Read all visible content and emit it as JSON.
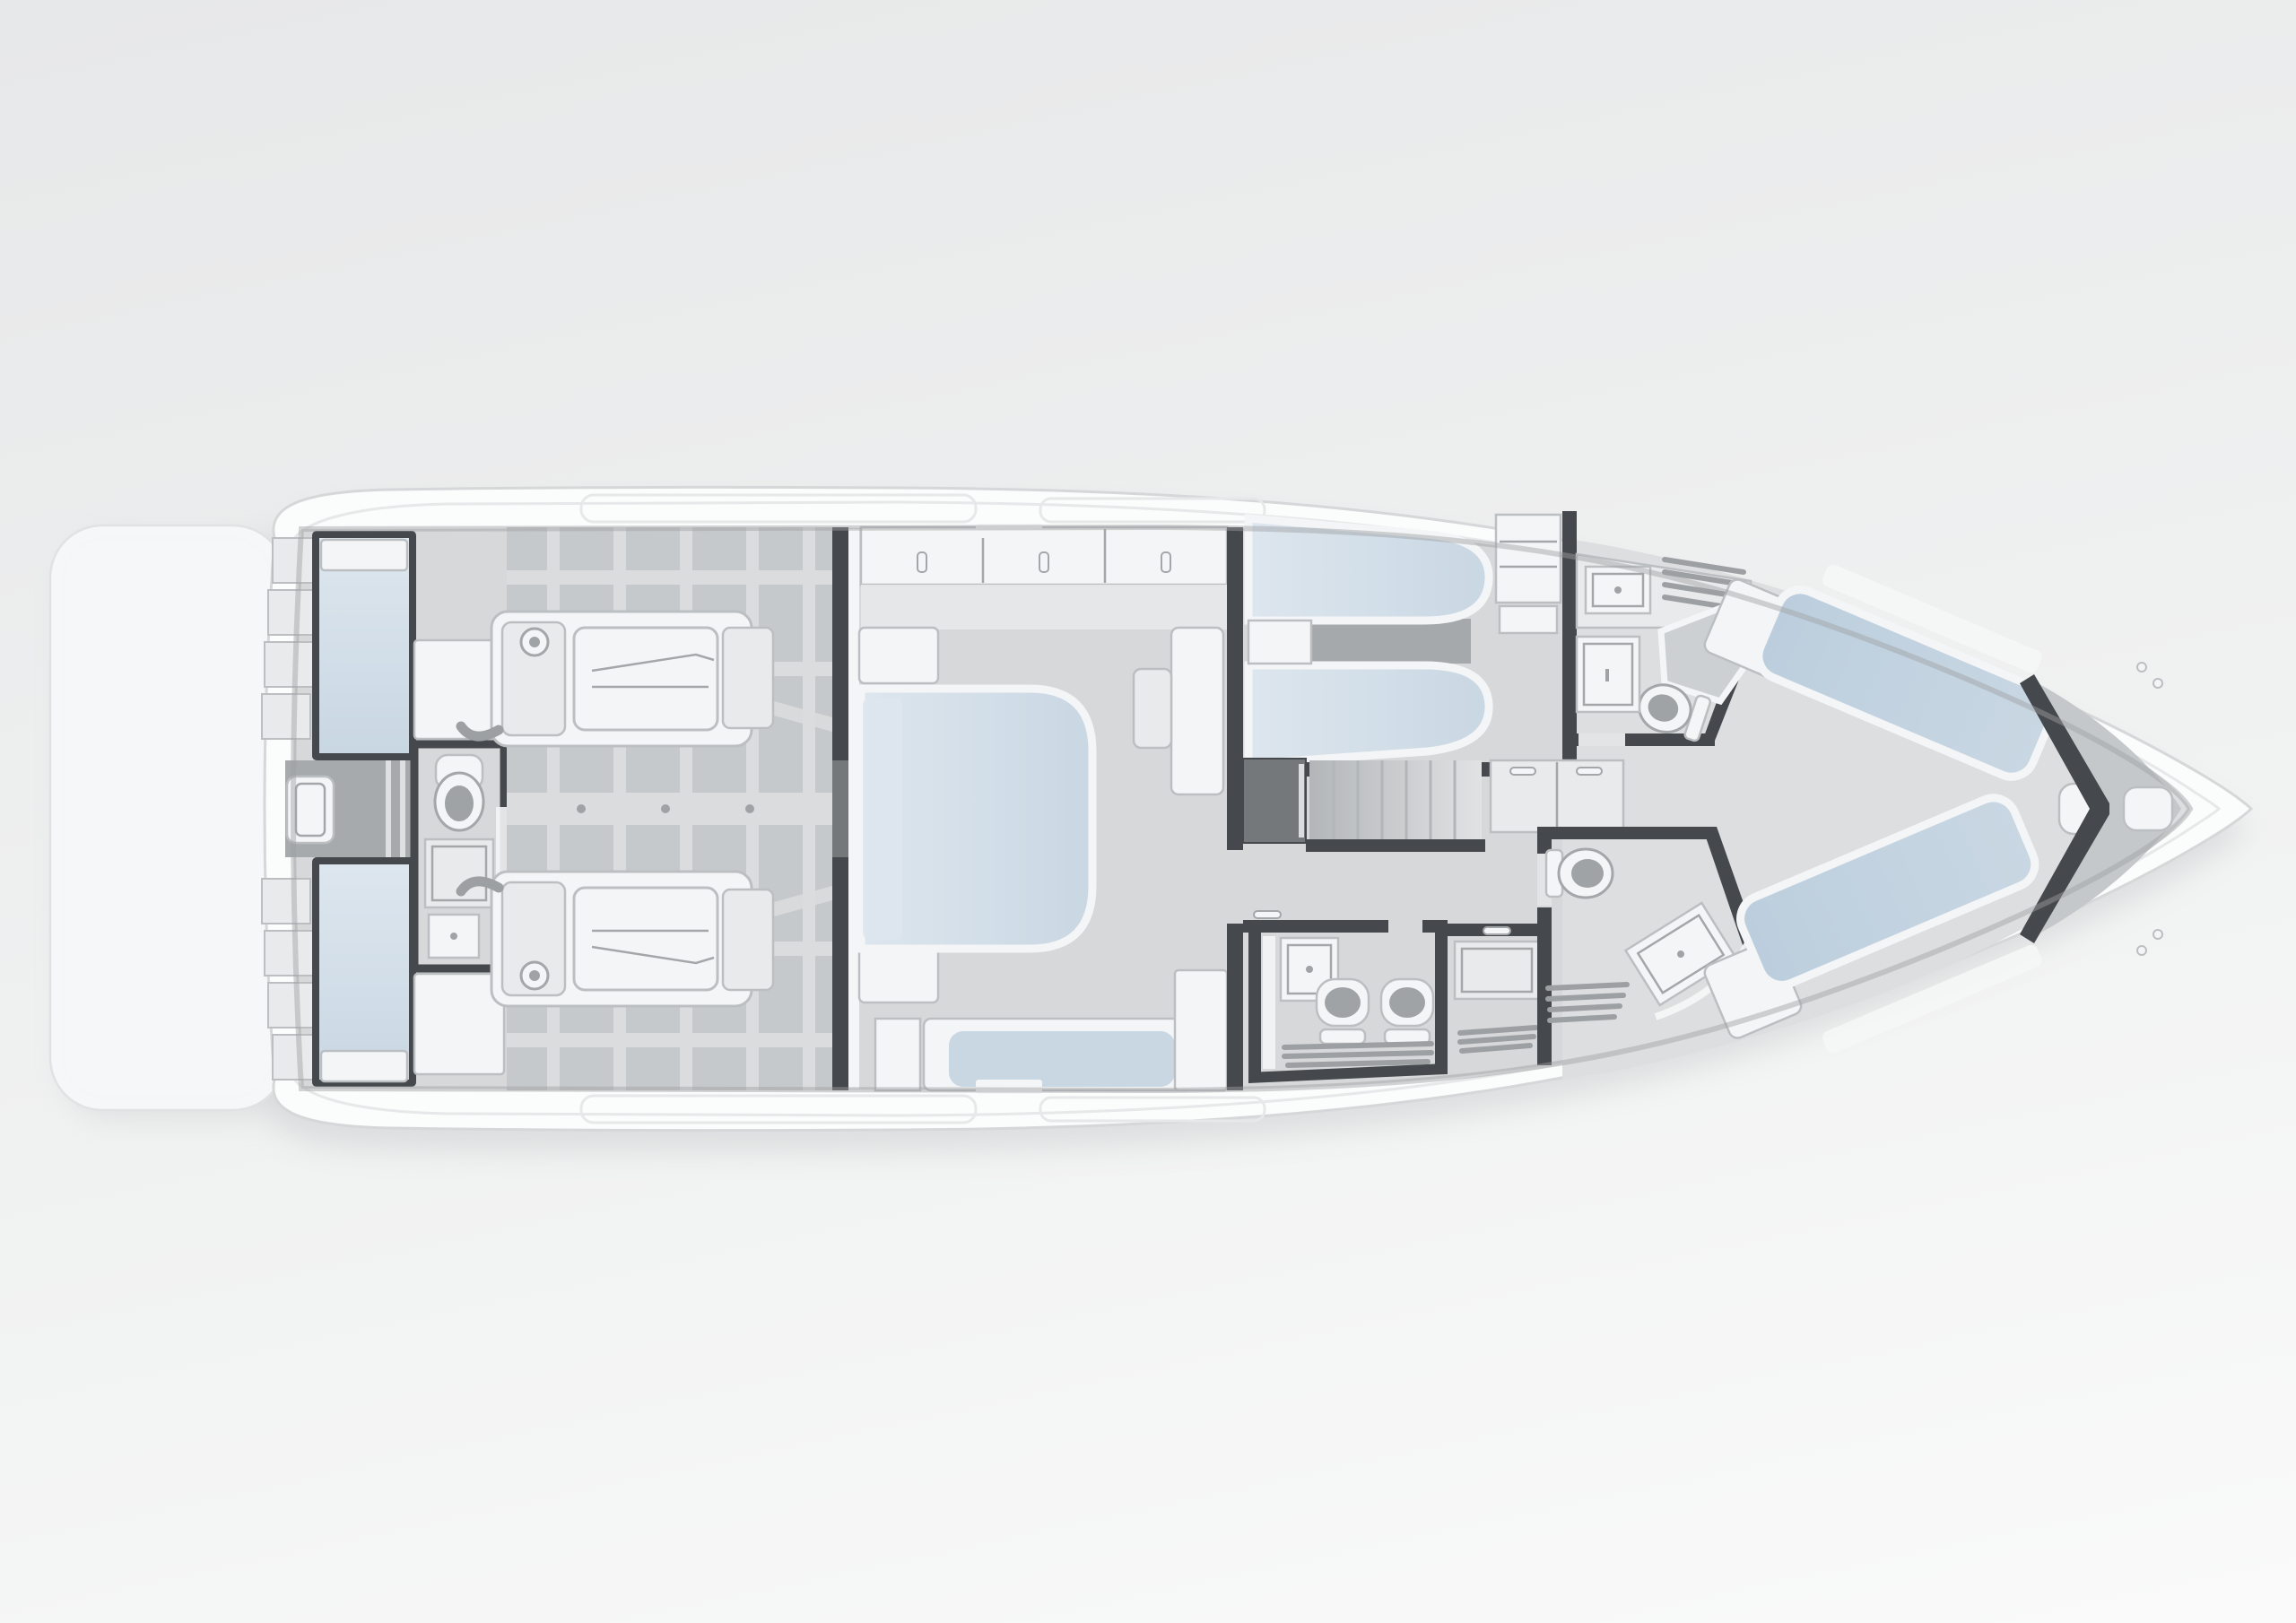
{
  "meta": {
    "scene_label": "Top-down rendered floor plan of a motor yacht lower deck",
    "view": "top-down",
    "orientation": "bow pointing right, stern with swim platform at left"
  },
  "labels": {
    "swim_platform": "Swim platform",
    "transom_steps": "Transom steps",
    "transom_lockers": "Transom lockers with blue glazed panels",
    "aft_passage": "Central transom passage",
    "day_head": "Aft technical day head with toilet, shower tray and sink",
    "engine_room": "Engine room with structural frames",
    "engine_port": "Port engine",
    "engine_starboard": "Starboard engine",
    "main_bulkhead": "Engine room bulkhead",
    "master_cabin": "Midship master cabin",
    "master_bed": "Master double bed",
    "master_wardrobe": "Master cabin wardrobe with three doors",
    "master_sofa": "Master cabin sofa",
    "master_vanity": "Vanity desk with seat",
    "guest_cabin": "Twin guest cabin",
    "guest_bed_upper": "Guest single berth, port",
    "guest_bed_lower": "Guest single berth, starboard",
    "guest_wardrobe": "Guest cabin shelving unit",
    "stairs": "Companionway stairs",
    "corridor": "Lower deck corridor",
    "aft_bathroom": "Aft bathroom with twin fixtures and sink",
    "shower_room": "Utility and shower compartment",
    "bathroom_port": "Forward port bathroom with shower cubicle",
    "bathroom_starboard": "Forward starboard bathroom with shower",
    "vip_cabin": "Bow VIP cabin",
    "vip_bed_port": "VIP berth, port side",
    "vip_bed_starboard": "VIP berth, starboard side",
    "forepeak_bulkhead": "Forepeak V bulkhead",
    "anchor_locker": "Anchor locker",
    "bow_cleats": "Bow deck cleats"
  },
  "inventory": {
    "engines": 2,
    "toilets": 4,
    "beds": 5,
    "sinks": 3,
    "shower_trays": 3,
    "stair_treads": 7,
    "wardrobe_doors": 3,
    "transom_steps_per_side": 4
  },
  "colors": {
    "bg_top": "#e7e8e9",
    "bg_mid": "#f0f1f1",
    "bg_bottom": "#fafafa",
    "hull": "#fbfcfc",
    "hull_edge": "#d5d7d9",
    "hull_inner_line": "#e6e8e9",
    "platform": "#f6f7f8",
    "platform_edge": "#e0e2e3",
    "shadow": "#aeb1b4",
    "floor": "#d6d8d9",
    "floor_fwd": "#dcdedf",
    "engine_floor": "#c6c9cb",
    "beam": "#dadcdd",
    "passage": "#a7aaac",
    "dark_floor": "#a6a9ab",
    "wall": "#45484c",
    "wall_mid": "#74787b",
    "white": "#f4f5f6",
    "panel": "#e9eaeb",
    "panel_edge": "#bcbfc1",
    "blue": "#c9d7e3",
    "blue_light": "#dde6ee",
    "blue_deep": "#bccedd",
    "locker": "#c5c8ca",
    "bolt": "#a0a3a6",
    "bowl": "#9fa3a6",
    "slat": "#9da0a3",
    "glass": "#cdd0d3",
    "stair_dark": "#b3b6b8",
    "stair_light": "#e0e2e3",
    "fixture_edge": "#a4a7a9",
    "inner_shadow": "#9da0a2"
  }
}
